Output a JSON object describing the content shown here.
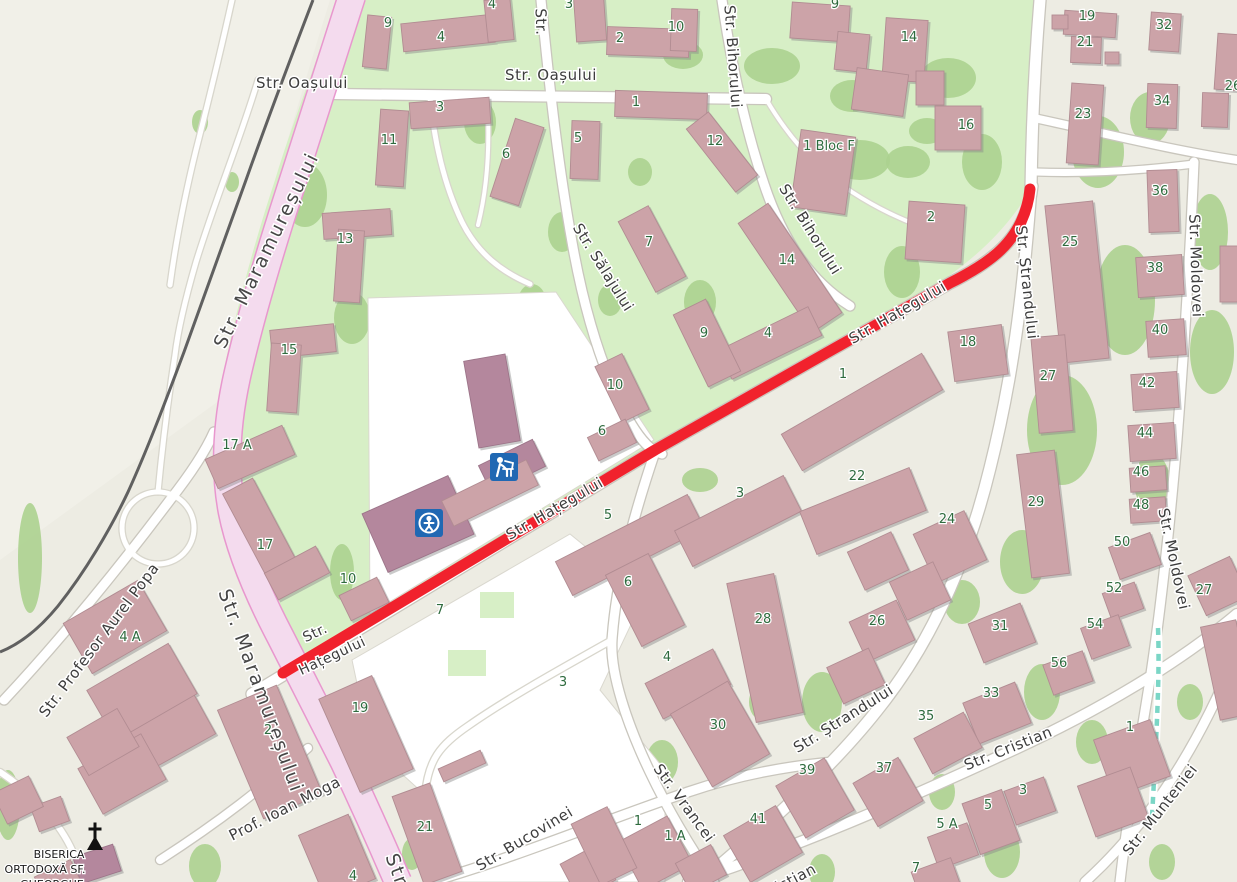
{
  "route": {
    "street": "Str. Hațegului",
    "color": "#F1222D"
  },
  "colors": {
    "background": "#EDECE3",
    "background_light": "#F1F0E8",
    "park": "#D7EFC6",
    "trees": "#ACD18F",
    "building": "#CCA3A8",
    "building_dark": "#B4879D",
    "main_road_fill": "#F4DBEE",
    "main_road_casing": "#E897CE",
    "railway": "#606060",
    "footpath_teal": "#7BD6C6",
    "house_number": "#2E6B3E",
    "street_label": "#3D3D3D",
    "poi_icon_blue": "#2068B3"
  },
  "streets": [
    {
      "label": "Str. Oașului",
      "x": 302,
      "y": 88,
      "r": 0,
      "s": 15
    },
    {
      "label": "Str. Oașului",
      "x": 551,
      "y": 80,
      "r": 0,
      "s": 15
    },
    {
      "label": "Str.",
      "x": 536,
      "y": 22,
      "r": 88,
      "s": 15
    },
    {
      "label": "Str. Bihorului",
      "x": 728,
      "y": 57,
      "r": 86,
      "s": 15
    },
    {
      "label": "Str. Bihorului",
      "x": 806,
      "y": 232,
      "r": 58,
      "s": 15
    },
    {
      "label": "Str. Maramureșului",
      "x": 272,
      "y": 253,
      "r": -64,
      "s": 19,
      "major": true
    },
    {
      "label": "Str. Maramureșului",
      "x": 255,
      "y": 693,
      "r": 70,
      "s": 19,
      "major": true
    },
    {
      "label": "Str",
      "x": 391,
      "y": 872,
      "r": 70,
      "s": 19,
      "major": true
    },
    {
      "label": "Str. Sălajului",
      "x": 599,
      "y": 270,
      "r": 58,
      "s": 15
    },
    {
      "label": "Str. Hațegului",
      "x": 900,
      "y": 317,
      "r": -30,
      "s": 15
    },
    {
      "label": "Str. Hațegului",
      "x": 557,
      "y": 513,
      "r": -30,
      "s": 15
    },
    {
      "label": "Str.",
      "x": 317,
      "y": 637,
      "r": -25,
      "s": 14
    },
    {
      "label": "Hațegului",
      "x": 334,
      "y": 660,
      "r": -25,
      "s": 14
    },
    {
      "label": "Str. Ștrandului",
      "x": 1022,
      "y": 283,
      "r": 84,
      "s": 15
    },
    {
      "label": "Str. Ștrandului",
      "x": 846,
      "y": 723,
      "r": -32,
      "s": 15
    },
    {
      "label": "Str. Moldovei",
      "x": 1191,
      "y": 266,
      "r": 88,
      "s": 15
    },
    {
      "label": "Str. Moldovei",
      "x": 1169,
      "y": 560,
      "r": 78,
      "s": 15
    },
    {
      "label": "Str. Vrancei",
      "x": 680,
      "y": 806,
      "r": 54,
      "s": 15
    },
    {
      "label": "Str. Bucovinei",
      "x": 527,
      "y": 843,
      "r": -31,
      "s": 15
    },
    {
      "label": "Str. Cristian",
      "x": 1010,
      "y": 753,
      "r": -22,
      "s": 15
    },
    {
      "label": "Str. Cristian",
      "x": 776,
      "y": 894,
      "r": -28,
      "s": 15
    },
    {
      "label": "Str. Munteniei",
      "x": 1164,
      "y": 813,
      "r": -52,
      "s": 15
    },
    {
      "label": "Prof. Ioan Moga",
      "x": 287,
      "y": 813,
      "r": -27,
      "s": 15
    },
    {
      "label": "Str. Profesor Aurel Popa",
      "x": 103,
      "y": 643,
      "r": -53,
      "s": 15
    }
  ],
  "house_numbers": [
    {
      "n": "4",
      "x": 492,
      "y": 8
    },
    {
      "n": "3",
      "x": 569,
      "y": 8
    },
    {
      "n": "9",
      "x": 388,
      "y": 27
    },
    {
      "n": "4",
      "x": 441,
      "y": 41
    },
    {
      "n": "2",
      "x": 620,
      "y": 42
    },
    {
      "n": "10",
      "x": 676,
      "y": 31
    },
    {
      "n": "9",
      "x": 835,
      "y": 8
    },
    {
      "n": "14",
      "x": 909,
      "y": 41
    },
    {
      "n": "19",
      "x": 1087,
      "y": 20
    },
    {
      "n": "21",
      "x": 1085,
      "y": 46
    },
    {
      "n": "32",
      "x": 1164,
      "y": 29
    },
    {
      "n": "26",
      "x": 1233,
      "y": 90
    },
    {
      "n": "23",
      "x": 1083,
      "y": 118
    },
    {
      "n": "34",
      "x": 1162,
      "y": 105
    },
    {
      "n": "16",
      "x": 966,
      "y": 129
    },
    {
      "n": "11",
      "x": 389,
      "y": 144
    },
    {
      "n": "3",
      "x": 440,
      "y": 111
    },
    {
      "n": "6",
      "x": 506,
      "y": 158
    },
    {
      "n": "5",
      "x": 578,
      "y": 142
    },
    {
      "n": "1",
      "x": 636,
      "y": 106
    },
    {
      "n": "12",
      "x": 715,
      "y": 145
    },
    {
      "n": "1 Bloc F",
      "x": 829,
      "y": 150
    },
    {
      "n": "13",
      "x": 345,
      "y": 243
    },
    {
      "n": "7",
      "x": 649,
      "y": 246
    },
    {
      "n": "14",
      "x": 787,
      "y": 264
    },
    {
      "n": "2",
      "x": 931,
      "y": 221
    },
    {
      "n": "25",
      "x": 1070,
      "y": 246
    },
    {
      "n": "36",
      "x": 1160,
      "y": 195
    },
    {
      "n": "38",
      "x": 1155,
      "y": 272
    },
    {
      "n": "15",
      "x": 289,
      "y": 354
    },
    {
      "n": "9",
      "x": 704,
      "y": 337
    },
    {
      "n": "4",
      "x": 768,
      "y": 337
    },
    {
      "n": "10",
      "x": 615,
      "y": 389
    },
    {
      "n": "6",
      "x": 602,
      "y": 435
    },
    {
      "n": "18",
      "x": 968,
      "y": 346
    },
    {
      "n": "1",
      "x": 843,
      "y": 378
    },
    {
      "n": "27",
      "x": 1048,
      "y": 380
    },
    {
      "n": "40",
      "x": 1160,
      "y": 334
    },
    {
      "n": "42",
      "x": 1147,
      "y": 387
    },
    {
      "n": "44",
      "x": 1145,
      "y": 437
    },
    {
      "n": "46",
      "x": 1141,
      "y": 476
    },
    {
      "n": "48",
      "x": 1141,
      "y": 509
    },
    {
      "n": "17 A",
      "x": 237,
      "y": 449
    },
    {
      "n": "17",
      "x": 265,
      "y": 549
    },
    {
      "n": "10",
      "x": 348,
      "y": 583
    },
    {
      "n": "29",
      "x": 1036,
      "y": 506
    },
    {
      "n": "50",
      "x": 1122,
      "y": 546
    },
    {
      "n": "52",
      "x": 1114,
      "y": 592
    },
    {
      "n": "54",
      "x": 1095,
      "y": 628
    },
    {
      "n": "56",
      "x": 1059,
      "y": 667
    },
    {
      "n": "5",
      "x": 608,
      "y": 519
    },
    {
      "n": "3",
      "x": 740,
      "y": 497
    },
    {
      "n": "22",
      "x": 857,
      "y": 480
    },
    {
      "n": "24",
      "x": 947,
      "y": 523
    },
    {
      "n": "6",
      "x": 628,
      "y": 586
    },
    {
      "n": "28",
      "x": 763,
      "y": 623
    },
    {
      "n": "26",
      "x": 877,
      "y": 625
    },
    {
      "n": "31",
      "x": 1000,
      "y": 630
    },
    {
      "n": "33",
      "x": 991,
      "y": 697
    },
    {
      "n": "4",
      "x": 667,
      "y": 661
    },
    {
      "n": "7",
      "x": 440,
      "y": 614
    },
    {
      "n": "19",
      "x": 360,
      "y": 712
    },
    {
      "n": "2",
      "x": 268,
      "y": 734
    },
    {
      "n": "4 A",
      "x": 130,
      "y": 641
    },
    {
      "n": "21",
      "x": 425,
      "y": 831
    },
    {
      "n": "3",
      "x": 563,
      "y": 686
    },
    {
      "n": "30",
      "x": 718,
      "y": 729
    },
    {
      "n": "35",
      "x": 926,
      "y": 720
    },
    {
      "n": "39",
      "x": 807,
      "y": 774
    },
    {
      "n": "37",
      "x": 884,
      "y": 772
    },
    {
      "n": "41",
      "x": 758,
      "y": 823
    },
    {
      "n": "1",
      "x": 638,
      "y": 825
    },
    {
      "n": "1 A",
      "x": 675,
      "y": 840
    },
    {
      "n": "5 A",
      "x": 947,
      "y": 828
    },
    {
      "n": "7",
      "x": 916,
      "y": 872
    },
    {
      "n": "5",
      "x": 988,
      "y": 809
    },
    {
      "n": "3",
      "x": 1023,
      "y": 794
    },
    {
      "n": "1",
      "x": 1130,
      "y": 731
    },
    {
      "n": "27",
      "x": 1204,
      "y": 594
    },
    {
      "n": "4",
      "x": 353,
      "y": 880
    }
  ],
  "pois": {
    "icons": [
      {
        "type": "school-icon",
        "x": 504,
        "y": 467
      },
      {
        "type": "kindergarten-icon",
        "x": 429,
        "y": 523
      },
      {
        "type": "church-icon",
        "x": 95,
        "y": 840
      }
    ],
    "church_label_lines": [
      {
        "t": "BISERICA",
        "x": 59,
        "y": 858
      },
      {
        "t": "ORTODOXĂ SF.",
        "x": 45,
        "y": 873
      },
      {
        "t": "GHEORGHE",
        "x": 52,
        "y": 888
      }
    ]
  },
  "buildings": [
    [
      377,
      42,
      24,
      52,
      6,
      0
    ],
    [
      448,
      33,
      92,
      28,
      -6,
      0
    ],
    [
      499,
      20,
      26,
      42,
      -6,
      0
    ],
    [
      590,
      18,
      30,
      46,
      -4,
      0
    ],
    [
      648,
      42,
      82,
      28,
      2,
      0
    ],
    [
      684,
      30,
      26,
      42,
      2,
      0
    ],
    [
      820,
      22,
      58,
      36,
      4,
      0
    ],
    [
      852,
      52,
      32,
      38,
      6,
      0
    ],
    [
      905,
      50,
      42,
      62,
      4,
      0
    ],
    [
      880,
      92,
      52,
      42,
      8,
      0
    ],
    [
      930,
      88,
      28,
      34,
      0,
      0
    ],
    [
      958,
      128,
      46,
      44,
      0,
      0
    ],
    [
      823,
      172,
      55,
      78,
      8,
      0
    ],
    [
      392,
      148,
      28,
      76,
      4,
      0
    ],
    [
      450,
      113,
      80,
      26,
      -4,
      0
    ],
    [
      517,
      162,
      30,
      82,
      18,
      0
    ],
    [
      585,
      150,
      28,
      58,
      2,
      0
    ],
    [
      661,
      105,
      92,
      26,
      2,
      0
    ],
    [
      722,
      152,
      28,
      80,
      -38,
      0
    ],
    [
      357,
      224,
      68,
      26,
      -4,
      0
    ],
    [
      349,
      266,
      26,
      72,
      4,
      0
    ],
    [
      652,
      249,
      34,
      80,
      -28,
      0
    ],
    [
      790,
      268,
      36,
      132,
      -34,
      0
    ],
    [
      770,
      343,
      100,
      32,
      -26,
      0
    ],
    [
      707,
      343,
      36,
      80,
      -26,
      0
    ],
    [
      622,
      388,
      30,
      62,
      -26,
      0
    ],
    [
      612,
      440,
      42,
      26,
      -26,
      0
    ],
    [
      935,
      232,
      56,
      58,
      4,
      0
    ],
    [
      978,
      353,
      54,
      50,
      -8,
      0
    ],
    [
      862,
      412,
      162,
      42,
      -30,
      0
    ],
    [
      303,
      341,
      64,
      28,
      -6,
      0
    ],
    [
      284,
      378,
      30,
      68,
      4,
      0
    ],
    [
      250,
      457,
      84,
      32,
      -24,
      0
    ],
    [
      262,
      532,
      34,
      104,
      -28,
      0
    ],
    [
      297,
      573,
      58,
      30,
      -28,
      0
    ],
    [
      364,
      599,
      42,
      28,
      -26,
      0
    ],
    [
      418,
      524,
      94,
      64,
      -24,
      1
    ],
    [
      492,
      401,
      42,
      88,
      -10,
      1
    ],
    [
      512,
      466,
      60,
      30,
      -26,
      1
    ],
    [
      490,
      493,
      94,
      28,
      -26,
      0
    ],
    [
      1090,
      24,
      52,
      24,
      4,
      0
    ],
    [
      1060,
      22,
      16,
      14,
      0,
      0
    ],
    [
      1086,
      50,
      30,
      26,
      2,
      0
    ],
    [
      1112,
      58,
      14,
      12,
      0,
      0
    ],
    [
      1165,
      32,
      30,
      38,
      4,
      0
    ],
    [
      1162,
      106,
      30,
      44,
      2,
      0
    ],
    [
      1085,
      124,
      32,
      80,
      4,
      0
    ],
    [
      1228,
      62,
      24,
      56,
      4,
      0
    ],
    [
      1215,
      110,
      26,
      34,
      2,
      0
    ],
    [
      1163,
      201,
      30,
      62,
      -2,
      0
    ],
    [
      1077,
      282,
      48,
      158,
      -6,
      0
    ],
    [
      1160,
      276,
      46,
      40,
      -4,
      0
    ],
    [
      1166,
      338,
      38,
      36,
      -4,
      0
    ],
    [
      1155,
      391,
      46,
      36,
      -4,
      0
    ],
    [
      1152,
      442,
      46,
      36,
      -4,
      0
    ],
    [
      1148,
      479,
      36,
      24,
      -4,
      0
    ],
    [
      1148,
      510,
      36,
      24,
      -4,
      0
    ],
    [
      1232,
      274,
      24,
      56,
      0,
      0
    ],
    [
      1052,
      384,
      34,
      96,
      -5,
      0
    ],
    [
      1043,
      514,
      38,
      124,
      -7,
      0
    ],
    [
      1135,
      556,
      44,
      34,
      -20,
      0
    ],
    [
      1123,
      601,
      34,
      28,
      -20,
      0
    ],
    [
      1105,
      637,
      40,
      33,
      -20,
      0
    ],
    [
      1068,
      673,
      42,
      32,
      -20,
      0
    ],
    [
      1218,
      586,
      46,
      44,
      -25,
      0
    ],
    [
      1228,
      670,
      36,
      95,
      -12,
      0
    ],
    [
      630,
      545,
      148,
      38,
      -27,
      0
    ],
    [
      738,
      521,
      122,
      40,
      -27,
      0
    ],
    [
      645,
      600,
      48,
      80,
      -27,
      0
    ],
    [
      688,
      684,
      76,
      40,
      -27,
      0
    ],
    [
      765,
      648,
      48,
      142,
      -12,
      0
    ],
    [
      863,
      511,
      118,
      46,
      -22,
      0
    ],
    [
      950,
      547,
      56,
      54,
      -25,
      0
    ],
    [
      878,
      561,
      48,
      42,
      -25,
      0
    ],
    [
      920,
      591,
      48,
      42,
      -25,
      0
    ],
    [
      882,
      631,
      52,
      44,
      -25,
      0
    ],
    [
      856,
      676,
      46,
      40,
      -25,
      0
    ],
    [
      1002,
      633,
      56,
      42,
      -22,
      0
    ],
    [
      997,
      713,
      56,
      44,
      -22,
      0
    ],
    [
      948,
      743,
      56,
      40,
      -28,
      0
    ],
    [
      720,
      734,
      66,
      84,
      -30,
      0
    ],
    [
      815,
      798,
      56,
      60,
      -30,
      0
    ],
    [
      763,
      844,
      60,
      54,
      -30,
      0
    ],
    [
      888,
      792,
      52,
      50,
      -30,
      0
    ],
    [
      655,
      853,
      56,
      54,
      -28,
      0
    ],
    [
      701,
      869,
      40,
      34,
      -28,
      0
    ],
    [
      588,
      872,
      42,
      40,
      -28,
      0
    ],
    [
      1132,
      758,
      60,
      60,
      -20,
      0
    ],
    [
      1113,
      802,
      56,
      54,
      -20,
      0
    ],
    [
      1030,
      801,
      42,
      36,
      -20,
      0
    ],
    [
      991,
      822,
      42,
      54,
      -20,
      0
    ],
    [
      953,
      846,
      42,
      34,
      -20,
      0
    ],
    [
      936,
      879,
      42,
      30,
      -20,
      0
    ],
    [
      366,
      734,
      58,
      102,
      -24,
      0
    ],
    [
      427,
      834,
      40,
      94,
      -20,
      0
    ],
    [
      462,
      766,
      46,
      14,
      -24,
      0
    ],
    [
      604,
      846,
      40,
      68,
      -26,
      0
    ],
    [
      270,
      752,
      64,
      118,
      -23,
      0
    ],
    [
      150,
      737,
      118,
      58,
      -29,
      0
    ],
    [
      122,
      774,
      72,
      52,
      -29,
      0
    ],
    [
      115,
      627,
      86,
      58,
      -30,
      0
    ],
    [
      142,
      692,
      94,
      58,
      -30,
      0
    ],
    [
      103,
      742,
      58,
      44,
      -30,
      0
    ],
    [
      50,
      814,
      32,
      26,
      -20,
      0
    ],
    [
      97,
      864,
      42,
      28,
      -18,
      1
    ],
    [
      337,
      857,
      54,
      70,
      -23,
      0
    ],
    [
      18,
      800,
      40,
      34,
      -26,
      0
    ],
    [
      58,
      880,
      40,
      26,
      -26,
      0
    ]
  ],
  "trees": [
    [
      305,
      195,
      22,
      32
    ],
    [
      352,
      318,
      18,
      26
    ],
    [
      480,
      122,
      16,
      22
    ],
    [
      562,
      232,
      14,
      20
    ],
    [
      610,
      300,
      12,
      16
    ],
    [
      683,
      55,
      20,
      14
    ],
    [
      772,
      66,
      28,
      18
    ],
    [
      852,
      96,
      22,
      16
    ],
    [
      948,
      78,
      28,
      20
    ],
    [
      902,
      272,
      18,
      26
    ],
    [
      700,
      302,
      16,
      22
    ],
    [
      762,
      232,
      14,
      18
    ],
    [
      640,
      172,
      12,
      14
    ],
    [
      982,
      162,
      20,
      28
    ],
    [
      927,
      131,
      18,
      13
    ],
    [
      1098,
      152,
      26,
      36
    ],
    [
      1150,
      118,
      20,
      26
    ],
    [
      1125,
      300,
      30,
      55
    ],
    [
      1062,
      430,
      35,
      55
    ],
    [
      1210,
      232,
      18,
      38
    ],
    [
      1212,
      352,
      22,
      42
    ],
    [
      1152,
      482,
      18,
      28
    ],
    [
      1022,
      562,
      22,
      32
    ],
    [
      962,
      602,
      18,
      22
    ],
    [
      1042,
      692,
      18,
      28
    ],
    [
      1092,
      742,
      16,
      22
    ],
    [
      1002,
      852,
      18,
      26
    ],
    [
      942,
      792,
      13,
      18
    ],
    [
      822,
      702,
      20,
      30
    ],
    [
      762,
      702,
      13,
      18
    ],
    [
      662,
      762,
      16,
      22
    ],
    [
      582,
      812,
      13,
      16
    ],
    [
      822,
      872,
      13,
      18
    ],
    [
      1162,
      862,
      13,
      18
    ],
    [
      700,
      480,
      18,
      12
    ],
    [
      498,
      603,
      16,
      12
    ],
    [
      342,
      572,
      12,
      28
    ],
    [
      30,
      558,
      12,
      55
    ],
    [
      92,
      632,
      12,
      22
    ],
    [
      152,
      742,
      16,
      26
    ],
    [
      205,
      866,
      16,
      22
    ],
    [
      8,
      805,
      12,
      35
    ],
    [
      412,
      854,
      10,
      16
    ],
    [
      545,
      881,
      12,
      10
    ],
    [
      860,
      160,
      30,
      20
    ],
    [
      908,
      162,
      22,
      16
    ],
    [
      200,
      122,
      8,
      12
    ],
    [
      232,
      182,
      7,
      10
    ],
    [
      1190,
      702,
      13,
      18
    ],
    [
      532,
      302,
      14,
      18
    ]
  ]
}
